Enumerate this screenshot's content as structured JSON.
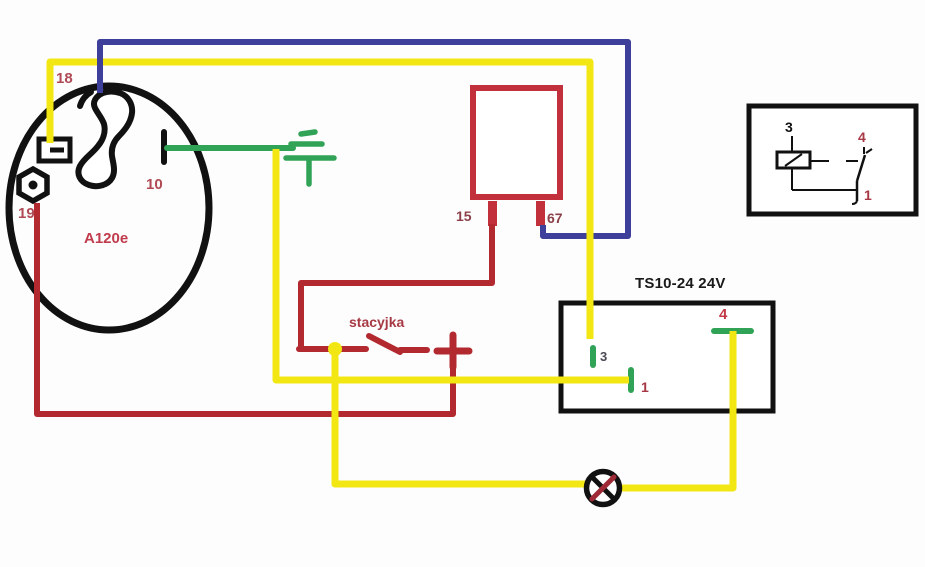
{
  "colors": {
    "wire_yellow": "#f2e713",
    "wire_blue": "#3e3e9b",
    "wire_red": "#b2292f",
    "wire_green": "#31a356",
    "component_red": "#c2303c",
    "lamp_cross_red": "#9e2a35",
    "outline_black": "#111111"
  },
  "alternator": {
    "label": "A120e",
    "pin_18": "18",
    "pin_19": "19",
    "pin_10": "10"
  },
  "regulator": {
    "pin_15": "15",
    "pin_67": "67"
  },
  "ignition_switch": {
    "label": "stacyjka"
  },
  "relay_box": {
    "title": "TS10-24 24V",
    "pin_3": "3",
    "pin_1": "1",
    "pin_4": "4"
  },
  "relay_inset": {
    "pin_3": "3",
    "pin_4": "4",
    "pin_1": "1"
  },
  "icons": {
    "ground": "ground-icon",
    "nut": "hex-nut-icon",
    "lamp": "indicator-lamp-icon",
    "battery_plus": "battery-plus-icon"
  }
}
